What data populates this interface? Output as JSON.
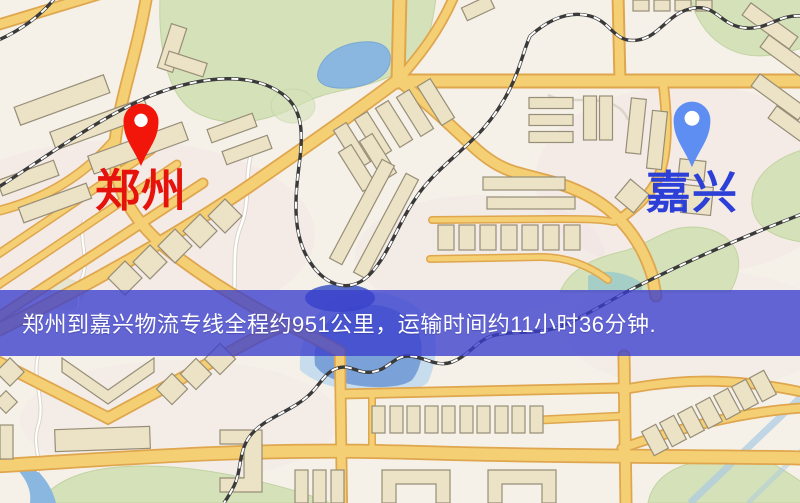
{
  "banner": {
    "text": "郑州到嘉兴物流专线全程约951公里，运输时间约11小时36分钟.",
    "background_color": "#3a3ecd",
    "text_color": "#ffffff"
  },
  "markers": {
    "origin": {
      "label": "郑州",
      "label_color": "#e6120c",
      "pin_color": "#f2150a",
      "pin_icon": "red-location-pin"
    },
    "destination": {
      "label": "嘉兴",
      "label_color": "#2c3fd6",
      "pin_color": "#5e8ef2",
      "pin_icon": "blue-location-pin"
    }
  },
  "route": {
    "origin_city": "郑州",
    "destination_city": "嘉兴",
    "service": "物流专线",
    "distance_text": "约951公里",
    "duration_text": "约11小时36分钟"
  },
  "map_palette": {
    "background": "#f5f1e8",
    "road_fill": "#f4cf74",
    "road_casing": "#dfa64e",
    "water": "#8ab7e0",
    "park": "#d5e1b9",
    "building": "#ece2c6",
    "railway": "#3a3a3a"
  }
}
